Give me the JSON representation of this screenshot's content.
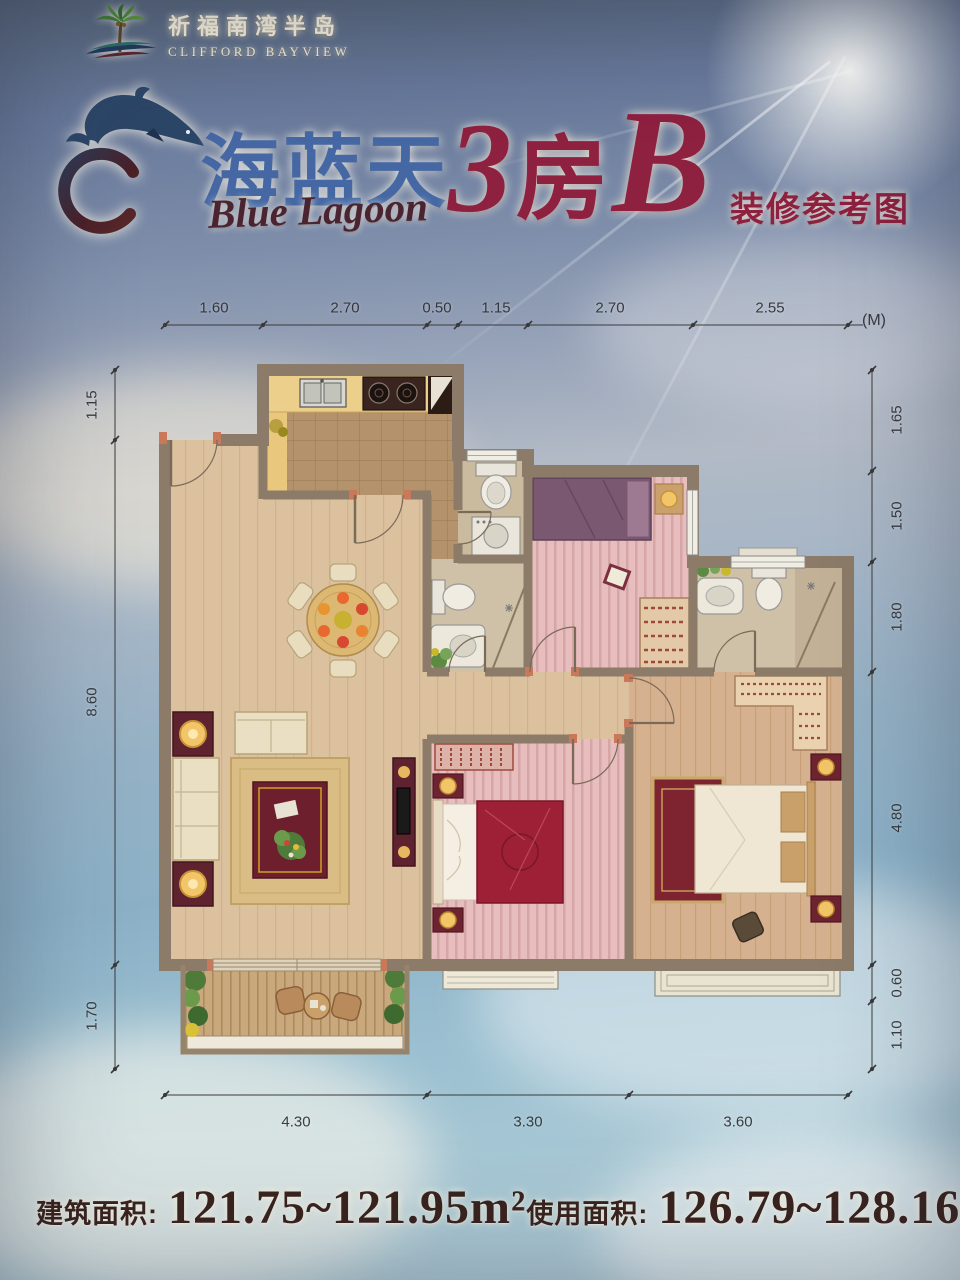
{
  "header": {
    "estate_name_cn": "祈福南湾半岛",
    "estate_name_en": "CLIFFORD BAYVIEW"
  },
  "brand": {
    "name_cn": "海蓝天",
    "name_en": "Blue Lagoon"
  },
  "unit": {
    "type_prefix": "3",
    "type_cjk": "房",
    "type_suffix": "B",
    "subtitle": "装修参考图"
  },
  "dims": {
    "unit": "(M)",
    "top": [
      "1.60",
      "2.70",
      "0.50",
      "1.15",
      "2.70",
      "2.55"
    ],
    "left": [
      "1.15",
      "8.60",
      "1.70"
    ],
    "right": [
      "1.65",
      "1.50",
      "1.80",
      "4.80",
      "0.60",
      "1.10"
    ],
    "bottom": [
      "4.30",
      "3.30",
      "3.60"
    ]
  },
  "footer": {
    "gross_area_label": "建筑面积:",
    "gross_area_value": "121.75~121.95m²",
    "usable_area_label": "使用面积:",
    "usable_area_value": "126.79~128.16m²"
  },
  "colors": {
    "title_accent": "#8e2040",
    "brand_blue": "#4568a4",
    "wall_taupe": "#8b7b68",
    "logo_cream": "#f6efdb"
  }
}
